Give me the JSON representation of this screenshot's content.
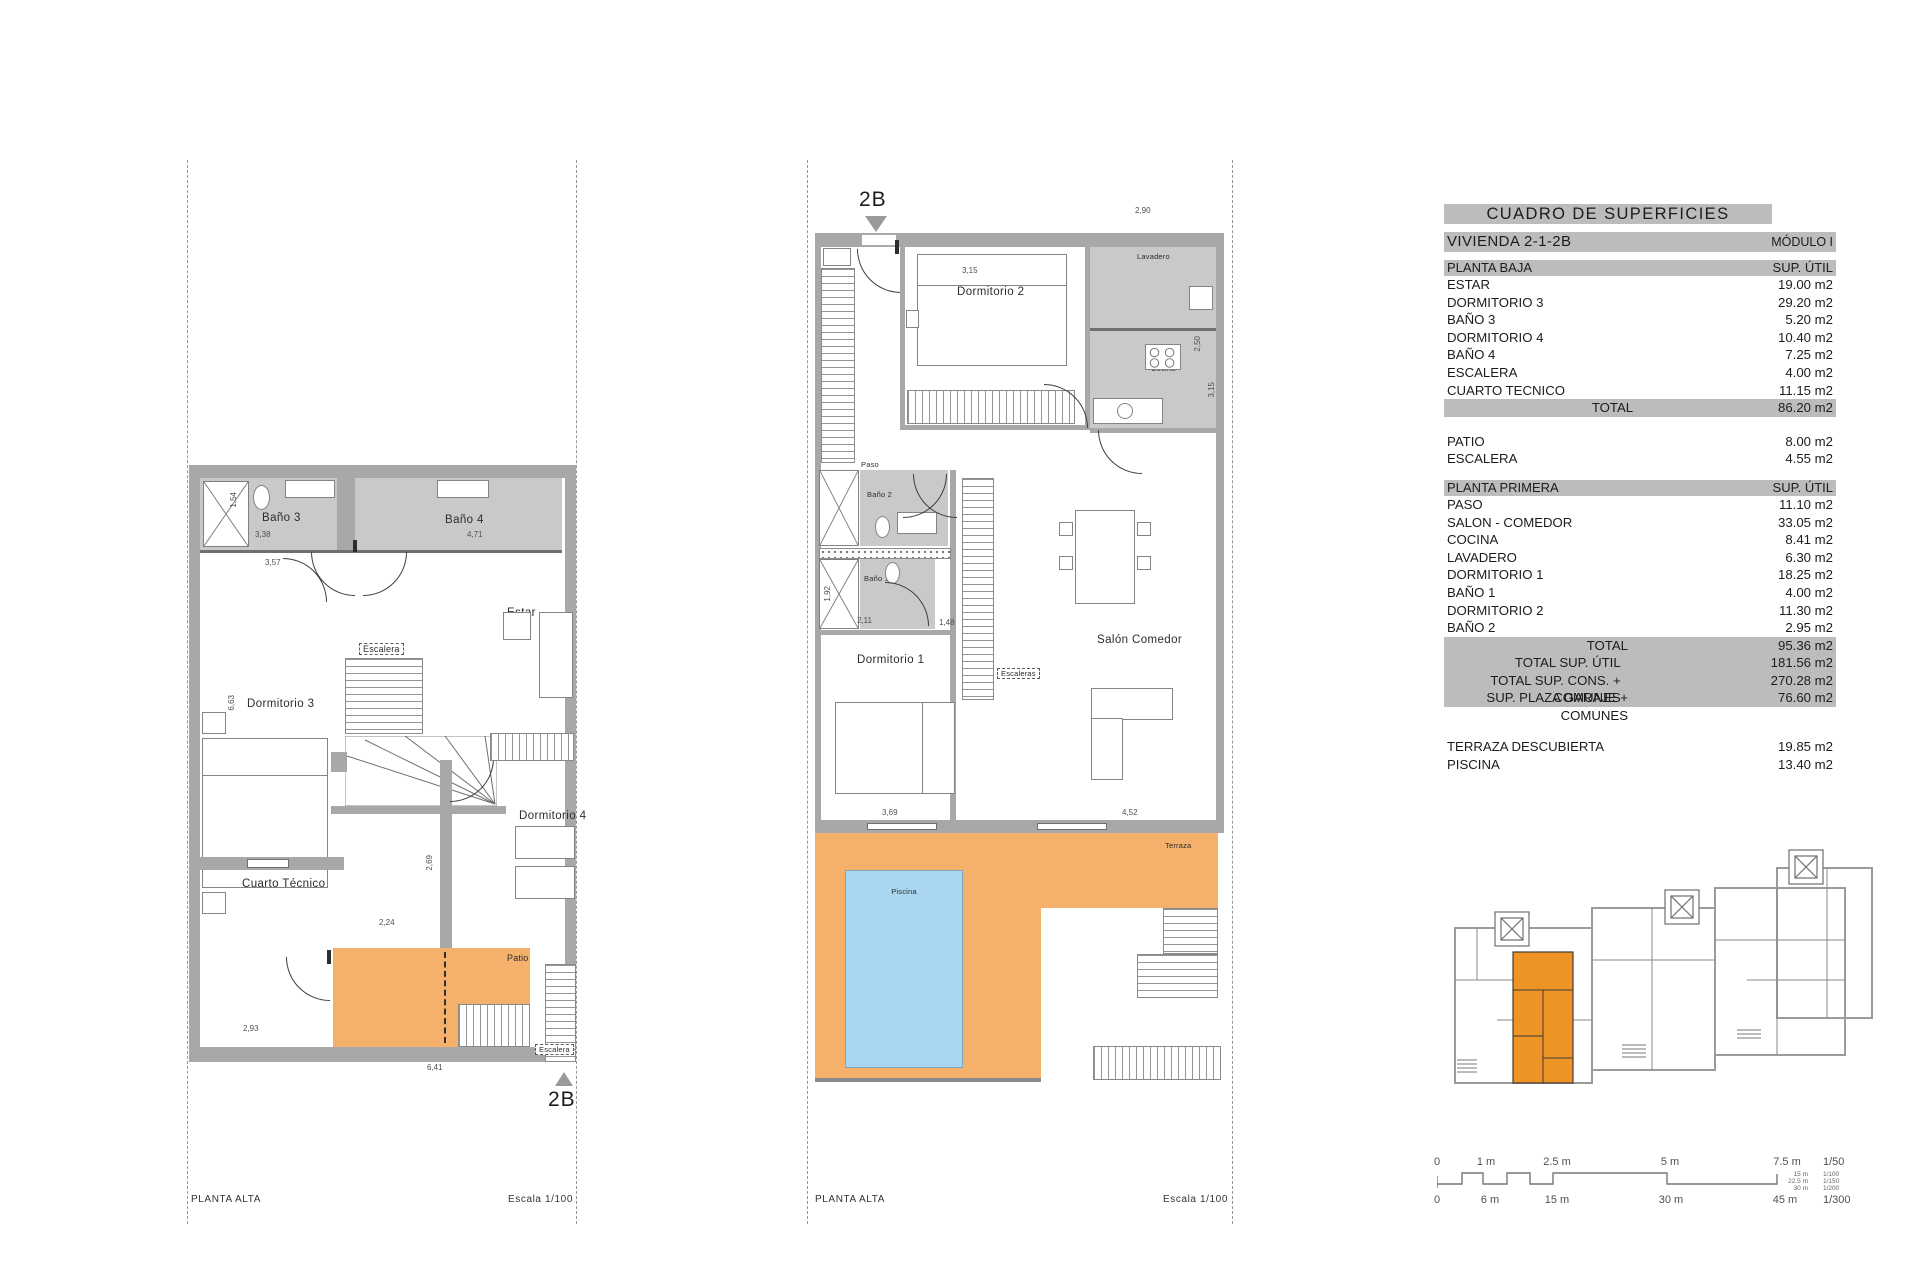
{
  "colors": {
    "wall_gray": "#a8a8a8",
    "bath_floor_gray": "#c9c9c9",
    "highlight_orange": "#f5b06c",
    "siteplan_orange": "#ee9425",
    "pool_blue": "#a9d6f0",
    "table_bar_gray": "#bcbcbc",
    "line_dark": "#3e3e3e"
  },
  "table": {
    "title": "CUADRO DE SUPERFICIES",
    "unit": "VIVIENDA 2-1-2B",
    "module": "MÓDULO I",
    "planta_baja": {
      "header": "PLANTA BAJA",
      "col": "SUP. ÚTIL",
      "rows": [
        {
          "label": "ESTAR",
          "value": "19.00 m2"
        },
        {
          "label": "DORMITORIO 3",
          "value": "29.20 m2"
        },
        {
          "label": "BAÑO 3",
          "value": "5.20 m2"
        },
        {
          "label": "DORMITORIO 4",
          "value": "10.40 m2"
        },
        {
          "label": "BAÑO 4",
          "value": "7.25 m2"
        },
        {
          "label": "ESCALERA",
          "value": "4.00 m2"
        },
        {
          "label": "CUARTO TECNICO",
          "value": "11.15 m2"
        }
      ],
      "total": {
        "label": "TOTAL",
        "value": "86.20 m2"
      }
    },
    "mid_rows": [
      {
        "label": "PATIO",
        "value": "8.00 m2"
      },
      {
        "label": "ESCALERA",
        "value": "4.55 m2"
      }
    ],
    "planta_primera": {
      "header": "PLANTA PRIMERA",
      "col": "SUP. ÚTIL",
      "rows": [
        {
          "label": "PASO",
          "value": "11.10 m2"
        },
        {
          "label": "SALON - COMEDOR",
          "value": "33.05 m2"
        },
        {
          "label": "COCINA",
          "value": "8.41 m2"
        },
        {
          "label": "LAVADERO",
          "value": "6.30 m2"
        },
        {
          "label": "DORMITORIO 1",
          "value": "18.25 m2"
        },
        {
          "label": "BAÑO 1",
          "value": "4.00 m2"
        },
        {
          "label": "DORMITORIO 2",
          "value": "11.30 m2"
        },
        {
          "label": "BAÑO 2",
          "value": "2.95 m2"
        }
      ]
    },
    "totals": [
      {
        "label": "TOTAL",
        "value": "95.36 m2"
      },
      {
        "label": "TOTAL SUP. ÚTIL",
        "value": "181.56 m2"
      },
      {
        "label": "TOTAL SUP. CONS. + COMUNES",
        "value": "270.28 m2"
      },
      {
        "label": "SUP. PLAZA GARAJE + COMUNES",
        "value": "76.60 m2"
      }
    ],
    "outdoor": [
      {
        "label": "TERRAZA DESCUBIERTA",
        "value": "19.85 m2"
      },
      {
        "label": "PISCINA",
        "value": "13.40 m2"
      }
    ]
  },
  "left_plan": {
    "marker": "2B",
    "footer_left": "PLANTA ALTA",
    "footer_right": "Escala 1/100",
    "rooms": {
      "bano3": "Baño 3",
      "bano4": "Baño 4",
      "estar": "Estar",
      "dormitorio3": "Dormitorio 3",
      "escalera": "Escalera",
      "dormitorio4": "Dormitorio 4",
      "cuarto_tecnico": "Cuarto Técnico",
      "patio": "Patio",
      "escalera_patio": "Escalera"
    },
    "dims": {
      "d154": "1,54",
      "d338": "3,38",
      "d471": "4,71",
      "d357": "3,57",
      "d663": "6,63",
      "d269": "2,69",
      "d224": "2,24",
      "d293": "2,93",
      "d641": "6,41"
    }
  },
  "center_plan": {
    "marker": "2B",
    "footer_left": "PLANTA ALTA",
    "footer_right": "Escala 1/100",
    "rooms": {
      "dormitorio2": "Dormitorio 2",
      "lavadero": "Lavadero",
      "cocina": "Cocina",
      "paso": "Paso",
      "bano2": "Baño 2",
      "bano1": "Baño 1",
      "dormitorio1": "Dormitorio 1",
      "salon": "Salón Comedor",
      "escaleras": "Escaleras",
      "terraza": "Terraza",
      "piscina": "Piscina"
    },
    "dims": {
      "d290": "2,90",
      "d315": "3,15",
      "d250": "2,50",
      "d211": "2,11",
      "d088": "0,88",
      "d315b": "3,15",
      "d192": "1,92",
      "d211b": "2,11",
      "d148": "1,48",
      "d347": "3,47",
      "d369": "3,69",
      "d452": "4,52"
    }
  },
  "scale_bar": {
    "top": [
      "0",
      "1 m",
      "2.5 m",
      "5 m",
      "7.5 m"
    ],
    "top_scale": "1/50",
    "mid_values": [
      "15 m",
      "22.5 m",
      "30 m"
    ],
    "mid_scales": [
      "1/100",
      "1/150",
      "1/200"
    ],
    "bottom": [
      "0",
      "6 m",
      "15 m",
      "30 m",
      "45 m"
    ],
    "bottom_scale": "1/300"
  }
}
